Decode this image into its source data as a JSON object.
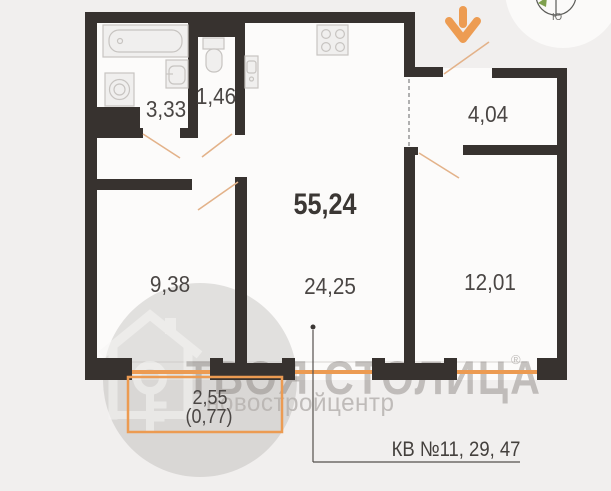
{
  "floor_plan": {
    "total_area": "55,24",
    "rooms": {
      "bathroom": "3,33",
      "toilet": "1,46",
      "hallway": "4,04",
      "room_1": "9,38",
      "kitchen_living": "24,25",
      "room_2": "12,01"
    },
    "balcony": {
      "area": "2,55",
      "area_reduced": "(0,77)"
    },
    "apartments_label": "КВ №11, 29, 47",
    "compass_south": "Ю"
  },
  "watermark": {
    "brand": "ТВОЯ СТОЛИЦА",
    "registered_mark": "®",
    "subtitle": "новостройцентр"
  },
  "icons": {
    "entrance-arrow-icon": "orange down arrow marking entrance",
    "compass-icon": "partial compass rose, south label",
    "bathtub-icon": "bathtub outline",
    "washing-machine-icon": "square with drum circle",
    "sink-icon": "wash basin",
    "toilet-icon": "toilet with tank",
    "kitchen-sink-icon": "narrow sink",
    "stove-icon": "4-burner cooktop",
    "brand-logo-icon": "gray disc with house and key"
  },
  "colors": {
    "background": "#f1efee",
    "floor": "#fcfbfa",
    "wall": "#37322f",
    "accent_orange": "#ec9b52",
    "door_swing": "#e3b289",
    "label_text": "#4a4644",
    "watermark_gray": "#b5b1ae",
    "compass_green": "#7fa04e"
  }
}
